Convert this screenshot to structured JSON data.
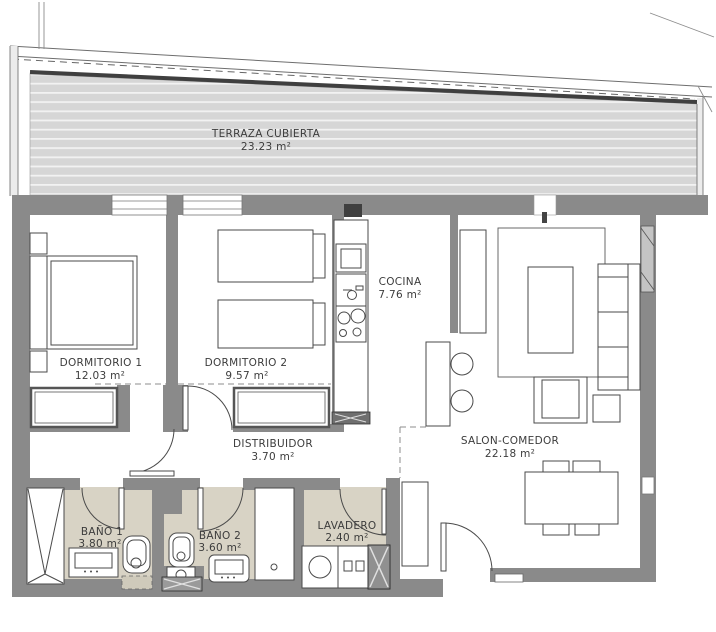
{
  "plan": {
    "type": "apartment-floor-plan",
    "rooms": [
      {
        "id": "terraza",
        "name": "TERRAZA CUBIERTA",
        "area": "23.23 m²"
      },
      {
        "id": "dormitorio-1",
        "name": "DORMITORIO 1",
        "area": "12.03 m²"
      },
      {
        "id": "dormitorio-2",
        "name": "DORMITORIO 2",
        "area": "9.57 m²"
      },
      {
        "id": "cocina",
        "name": "COCINA",
        "area": "7.76 m²"
      },
      {
        "id": "salon-comedor",
        "name": "SALON-COMEDOR",
        "area": "22.18 m²"
      },
      {
        "id": "distribuidor",
        "name": "DISTRIBUIDOR",
        "area": "3.70 m²"
      },
      {
        "id": "bano-1",
        "name": "BAÑO 1",
        "area": "3.80 m²"
      },
      {
        "id": "bano-2",
        "name": "BAÑO 2",
        "area": "3.60 m²"
      },
      {
        "id": "lavadero",
        "name": "LAVADERO",
        "area": "2.40 m²"
      }
    ],
    "colors": {
      "wall": "#8a8a8a",
      "terrace_deck": "#d6d6d6",
      "deck_stripe": "#f2f2f2",
      "wet_room_floor": "#d8d3c5",
      "drawing_line": "#4a4a4a",
      "label_text": "#3c3c3c",
      "background": "#ffffff"
    }
  }
}
